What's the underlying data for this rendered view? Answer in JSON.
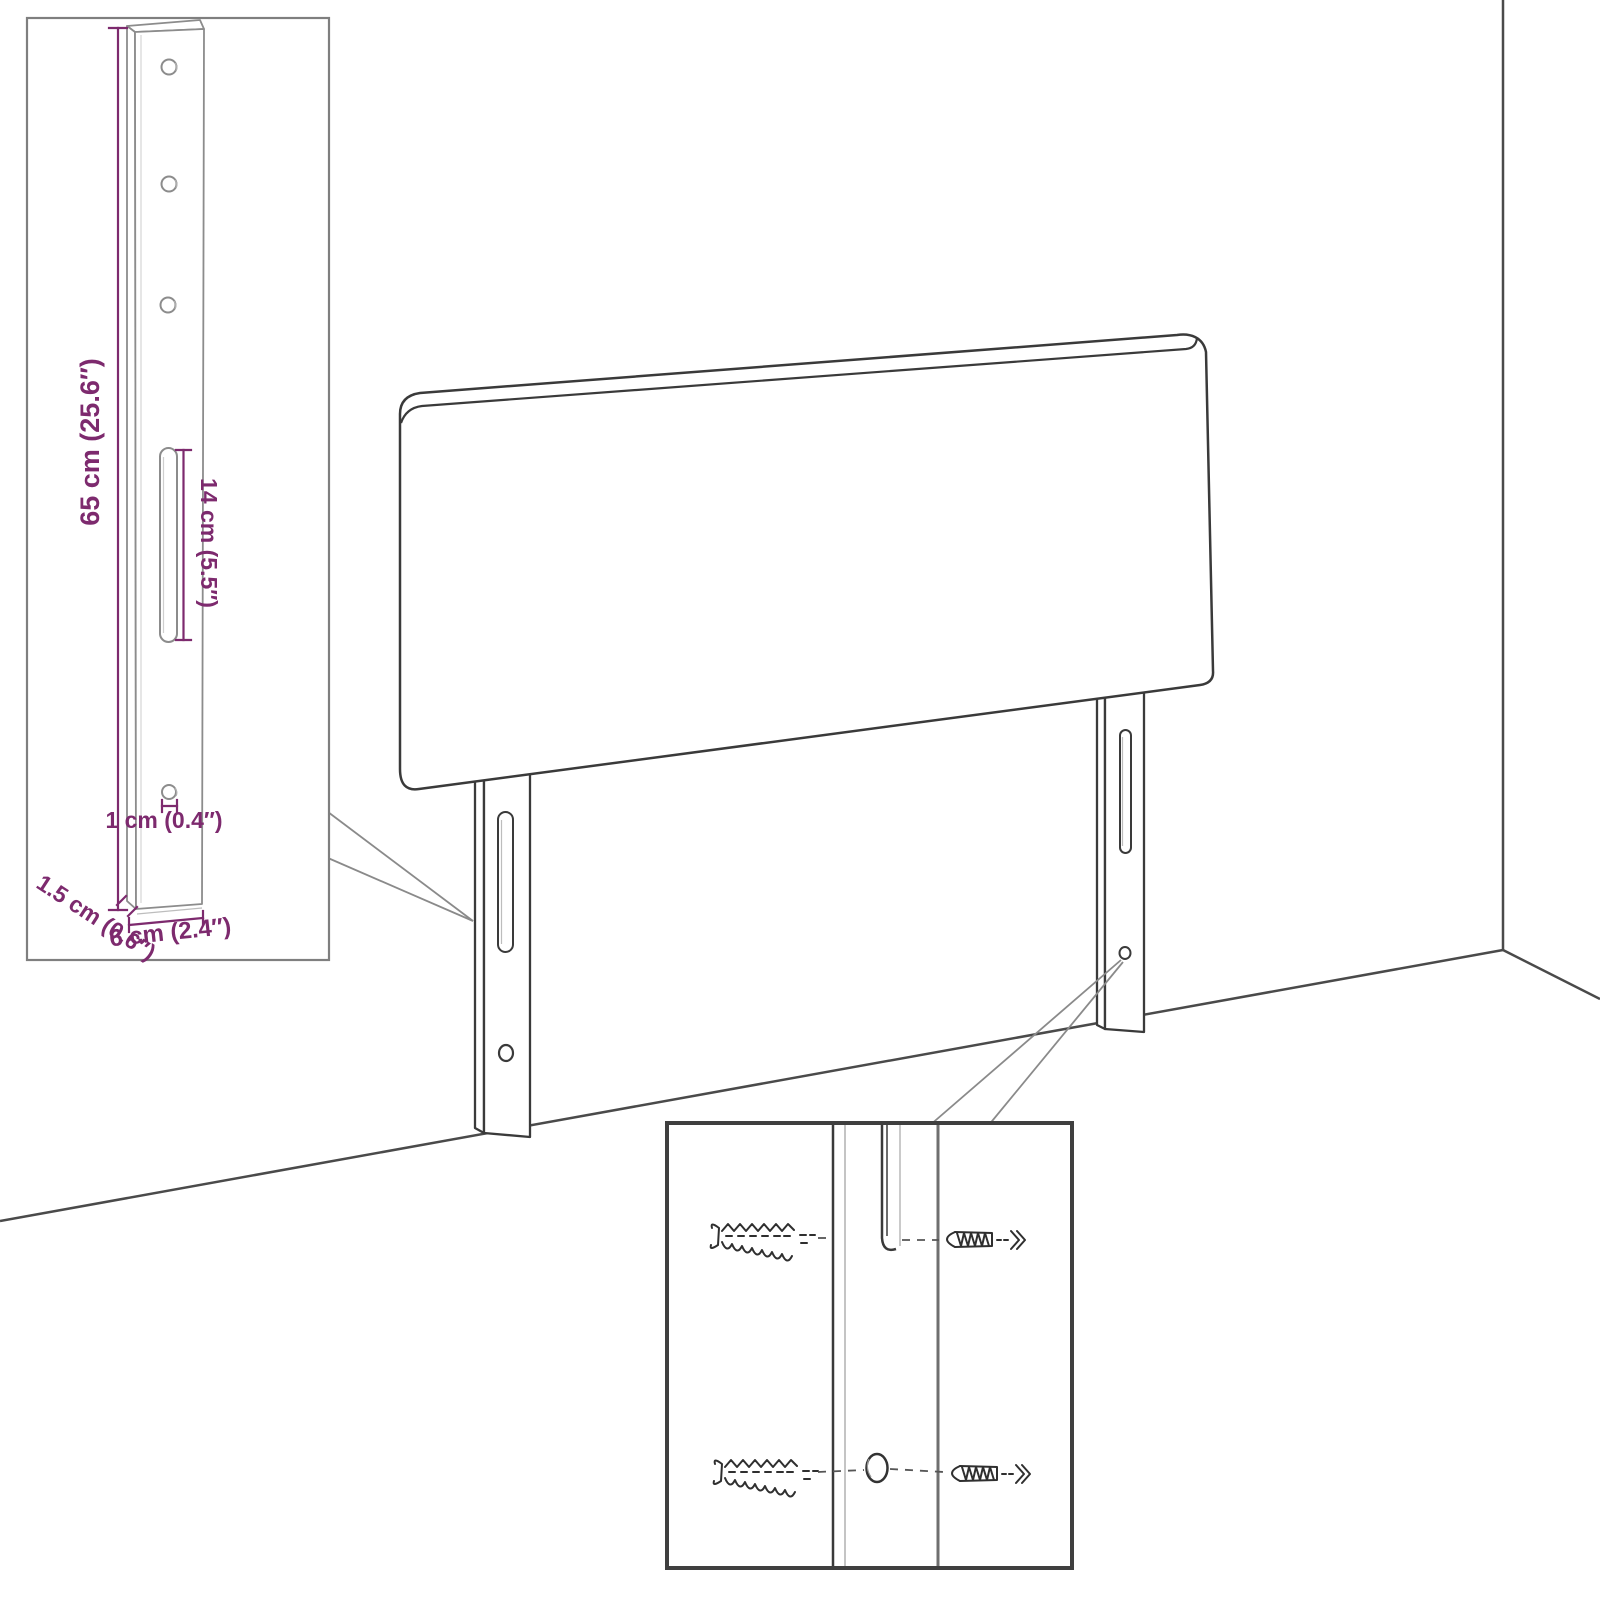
{
  "diagram_title": "headboard-mounting-dimension-diagram",
  "dimensions": {
    "height": {
      "label": "65 cm (25.6″)"
    },
    "slot": {
      "label": "14 cm (5.5″)"
    },
    "hole": {
      "label": "1 cm (0.4″)"
    },
    "depth": {
      "label": "1.5 cm (0.6″)"
    },
    "width": {
      "label": "6 cm (2.4″)"
    }
  },
  "colors": {
    "dimension_accent": "#7D2A6E",
    "outline_dark": "#3A3A3A",
    "outline_gray": "#8A8A8A",
    "room_line": "#4A4A4A",
    "inset_border_light": "#7F7F7F",
    "inset_border_dark": "#3F3F3F",
    "hardware_sketch": "#2F2F2F"
  }
}
